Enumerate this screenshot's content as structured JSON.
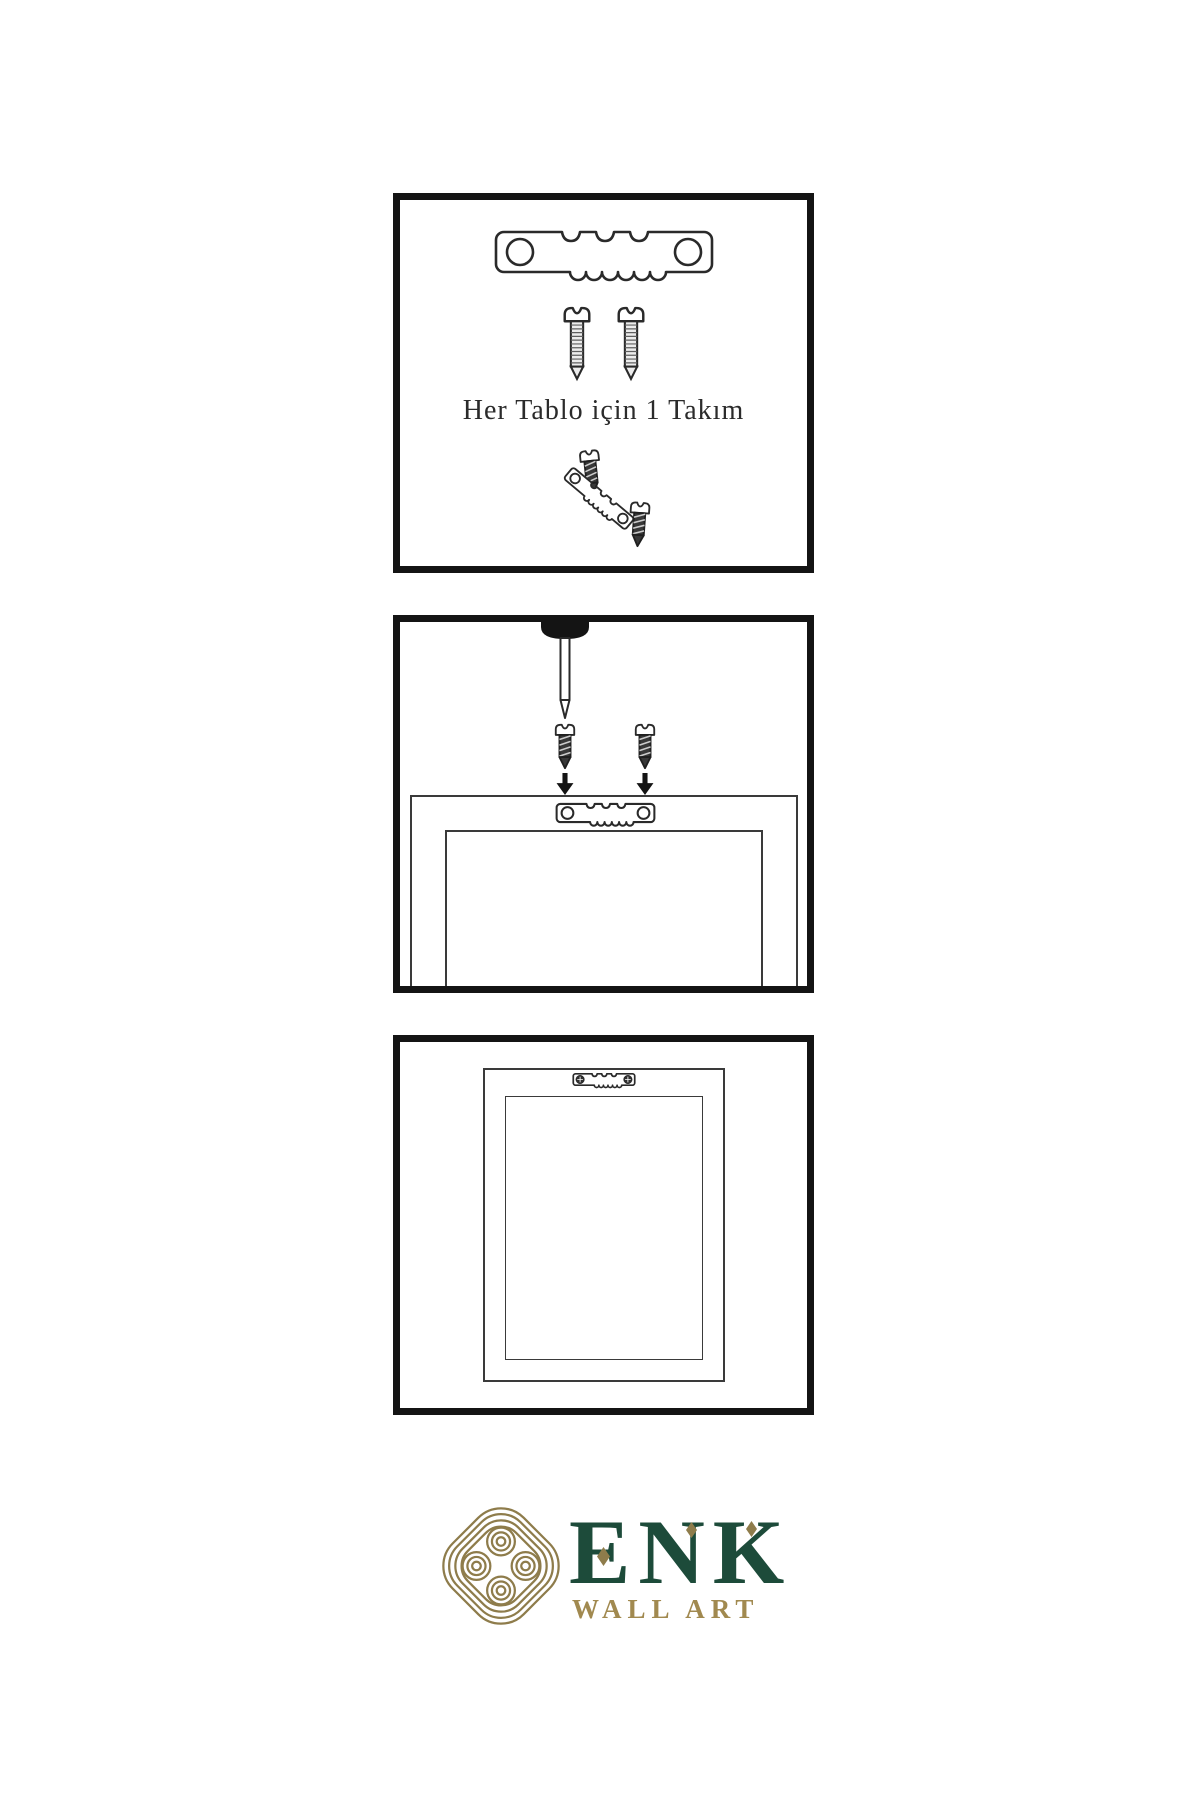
{
  "document": {
    "kind": "wall-art-hanging-instructions",
    "background": "#ffffff"
  },
  "panels": [
    {
      "name": "kit-contents",
      "caption": "Her Tablo için 1 Takım",
      "illustrations": [
        "sawtooth-hanger",
        "mounting-screw",
        "mounting-screw",
        "screw-entering-tilted-hanger",
        "tilted-sawtooth-hanger",
        "mounting-screw"
      ]
    },
    {
      "name": "installation-step",
      "illustrations": [
        "wall-nail",
        "mounting-screw",
        "mounting-screw",
        "down-arrow",
        "down-arrow",
        "frame-back-outline",
        "sawtooth-hanger-on-frame"
      ]
    },
    {
      "name": "hanger-installed",
      "illustrations": [
        "frame-back-outline",
        "installed-sawtooth-hanger-with-screws"
      ]
    }
  ],
  "logo": {
    "brand": "ENK",
    "tagline": "WALL ART",
    "symbol": "interlaced-knot-icon"
  },
  "colors": {
    "ink": "#2a2a2a",
    "panel_border": "#141414",
    "caption_ink": "#2b2b2b",
    "logo_green": "#1d4b3a",
    "logo_gold": "#8e7c4b",
    "tagline_gold": "#a1894f"
  }
}
